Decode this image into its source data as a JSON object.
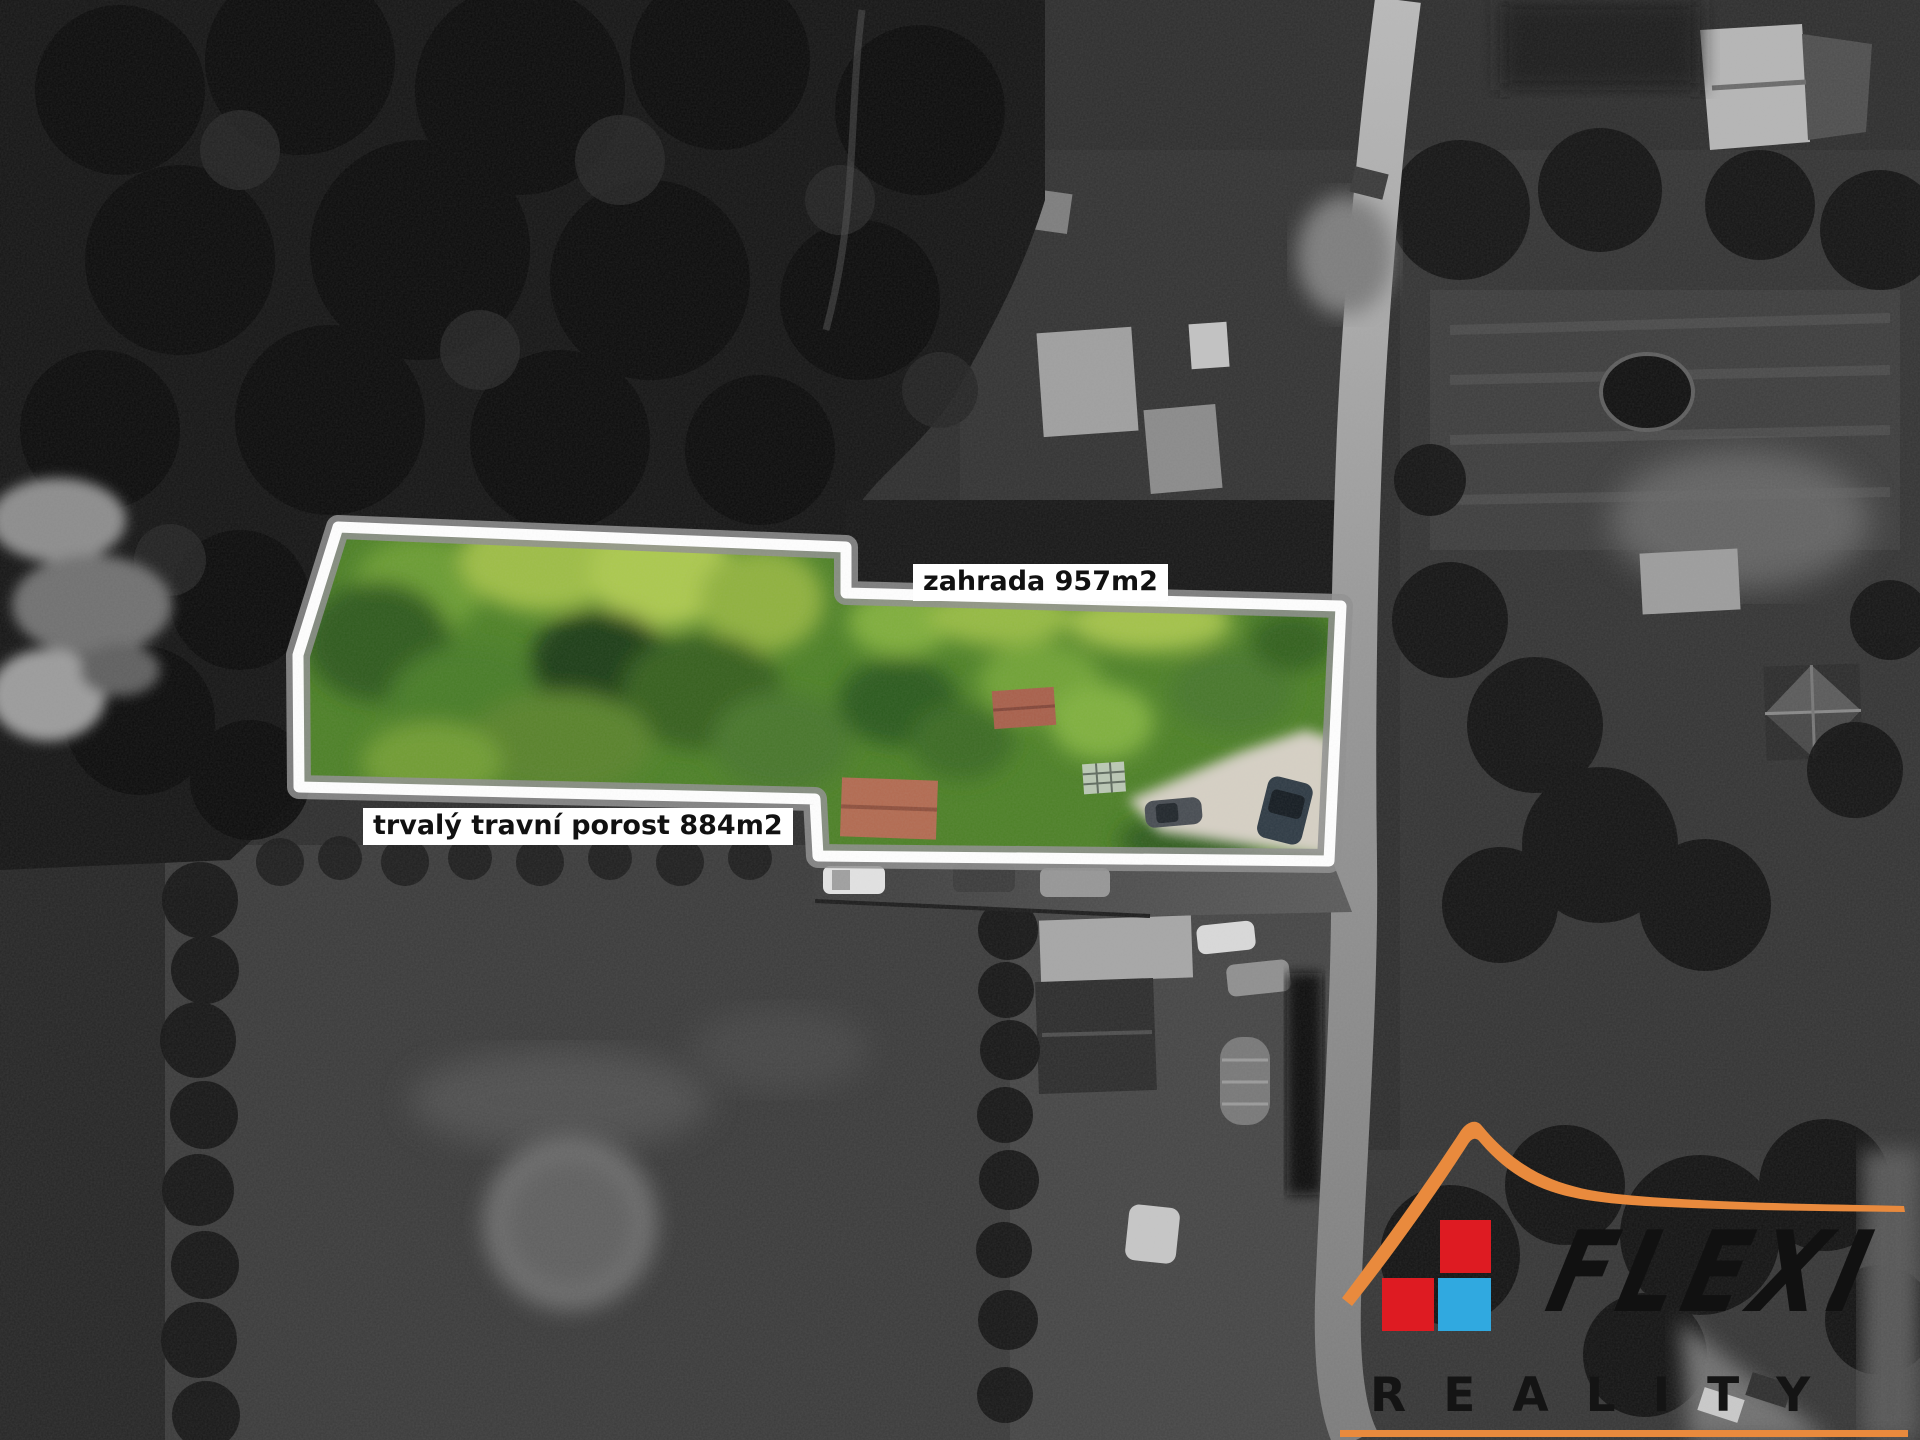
{
  "annotations": {
    "garden_label": "zahrada 957m2",
    "grassland_label": "trvalý travní porost 884m2",
    "garden_area_m2": 957,
    "grassland_area_m2": 884
  },
  "branding": {
    "name": "FLEXI",
    "subtitle": "REALITY",
    "colors": {
      "orange": "#e98a3d",
      "red": "#de1b22",
      "blue": "#30a9e0",
      "text": "#121212"
    }
  },
  "parcel": {
    "outline_white": "#ffffff",
    "outline_gray": "#8f8f8f"
  }
}
